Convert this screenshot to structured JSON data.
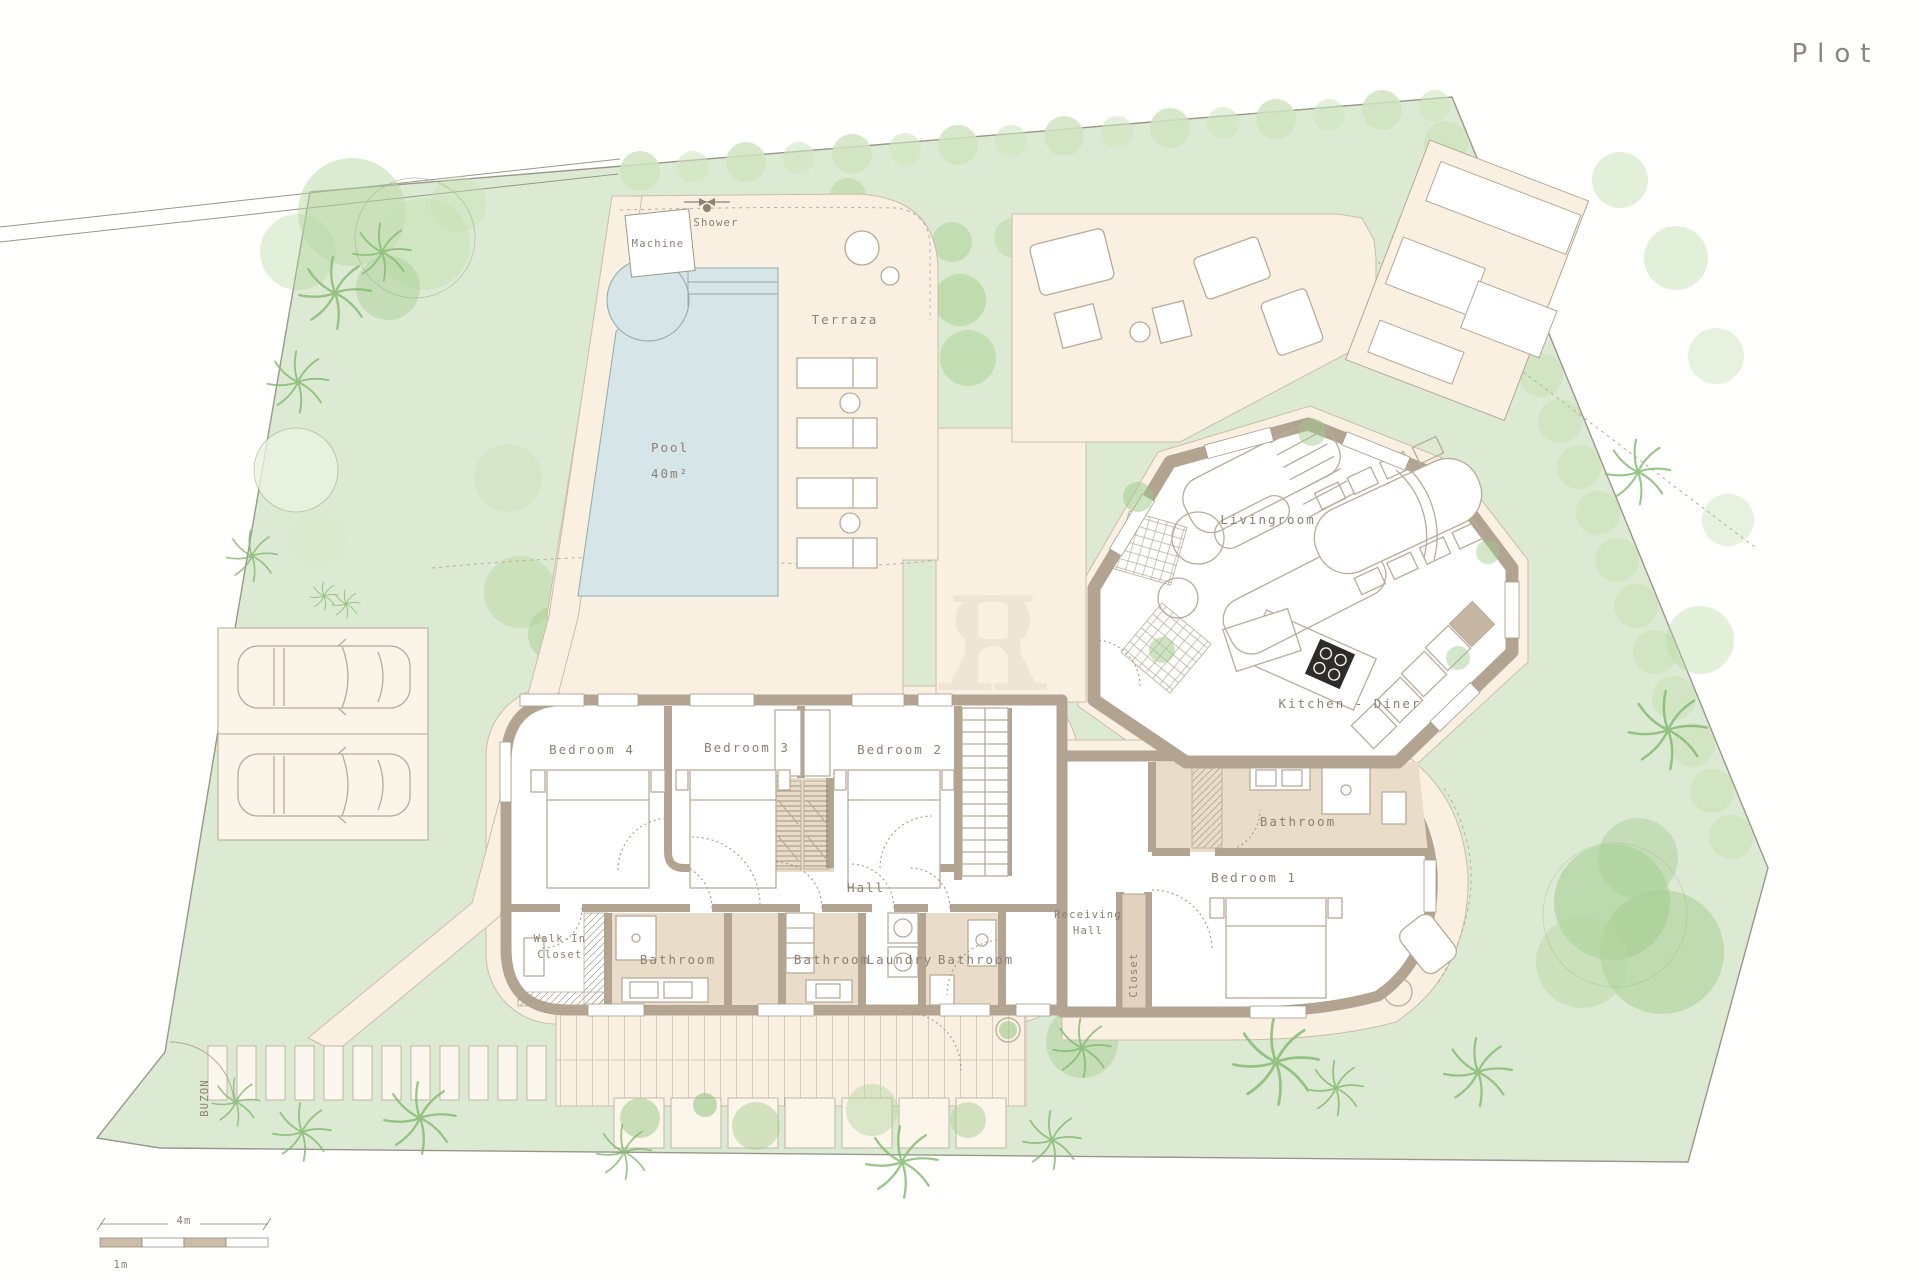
{
  "title": "Plot",
  "watermark": "R",
  "colors": {
    "background": "#fffffe",
    "garden_green": "#dcead3",
    "foliage_green": "#aed29a",
    "hedge_green": "#cfe4bf",
    "deck_cream": "#f9f0e2",
    "pool_blue": "#d6e5e7",
    "wall_taupe": "#b3a492",
    "floor_tan": "#e9dcc8",
    "line_tan": "#b9ab97",
    "text_gray": "#8a8173"
  },
  "site": {
    "buzon": "BUZON"
  },
  "outdoor": {
    "machine": "Machine",
    "shower": "Shower",
    "terraza": "Terraza",
    "pool_name": "Pool",
    "pool_area": "40m²"
  },
  "rooms": {
    "livingroom": "Livingroom",
    "kitchen_diner": "Kitchen - Diner",
    "bedroom4": "Bedroom 4",
    "bedroom3": "Bedroom 3",
    "bedroom2": "Bedroom 2",
    "bedroom1": "Bedroom 1",
    "hall": "Hall",
    "bathroom": "Bathroom",
    "laundry": "Laundry",
    "walk_in_line1": "Walk-In",
    "walk_in_line2": "Closet",
    "receiving_line1": "Receiving",
    "receiving_line2": "Hall",
    "closet": "Closet"
  },
  "scale_bar": {
    "major": "4m",
    "minor": "1m"
  }
}
